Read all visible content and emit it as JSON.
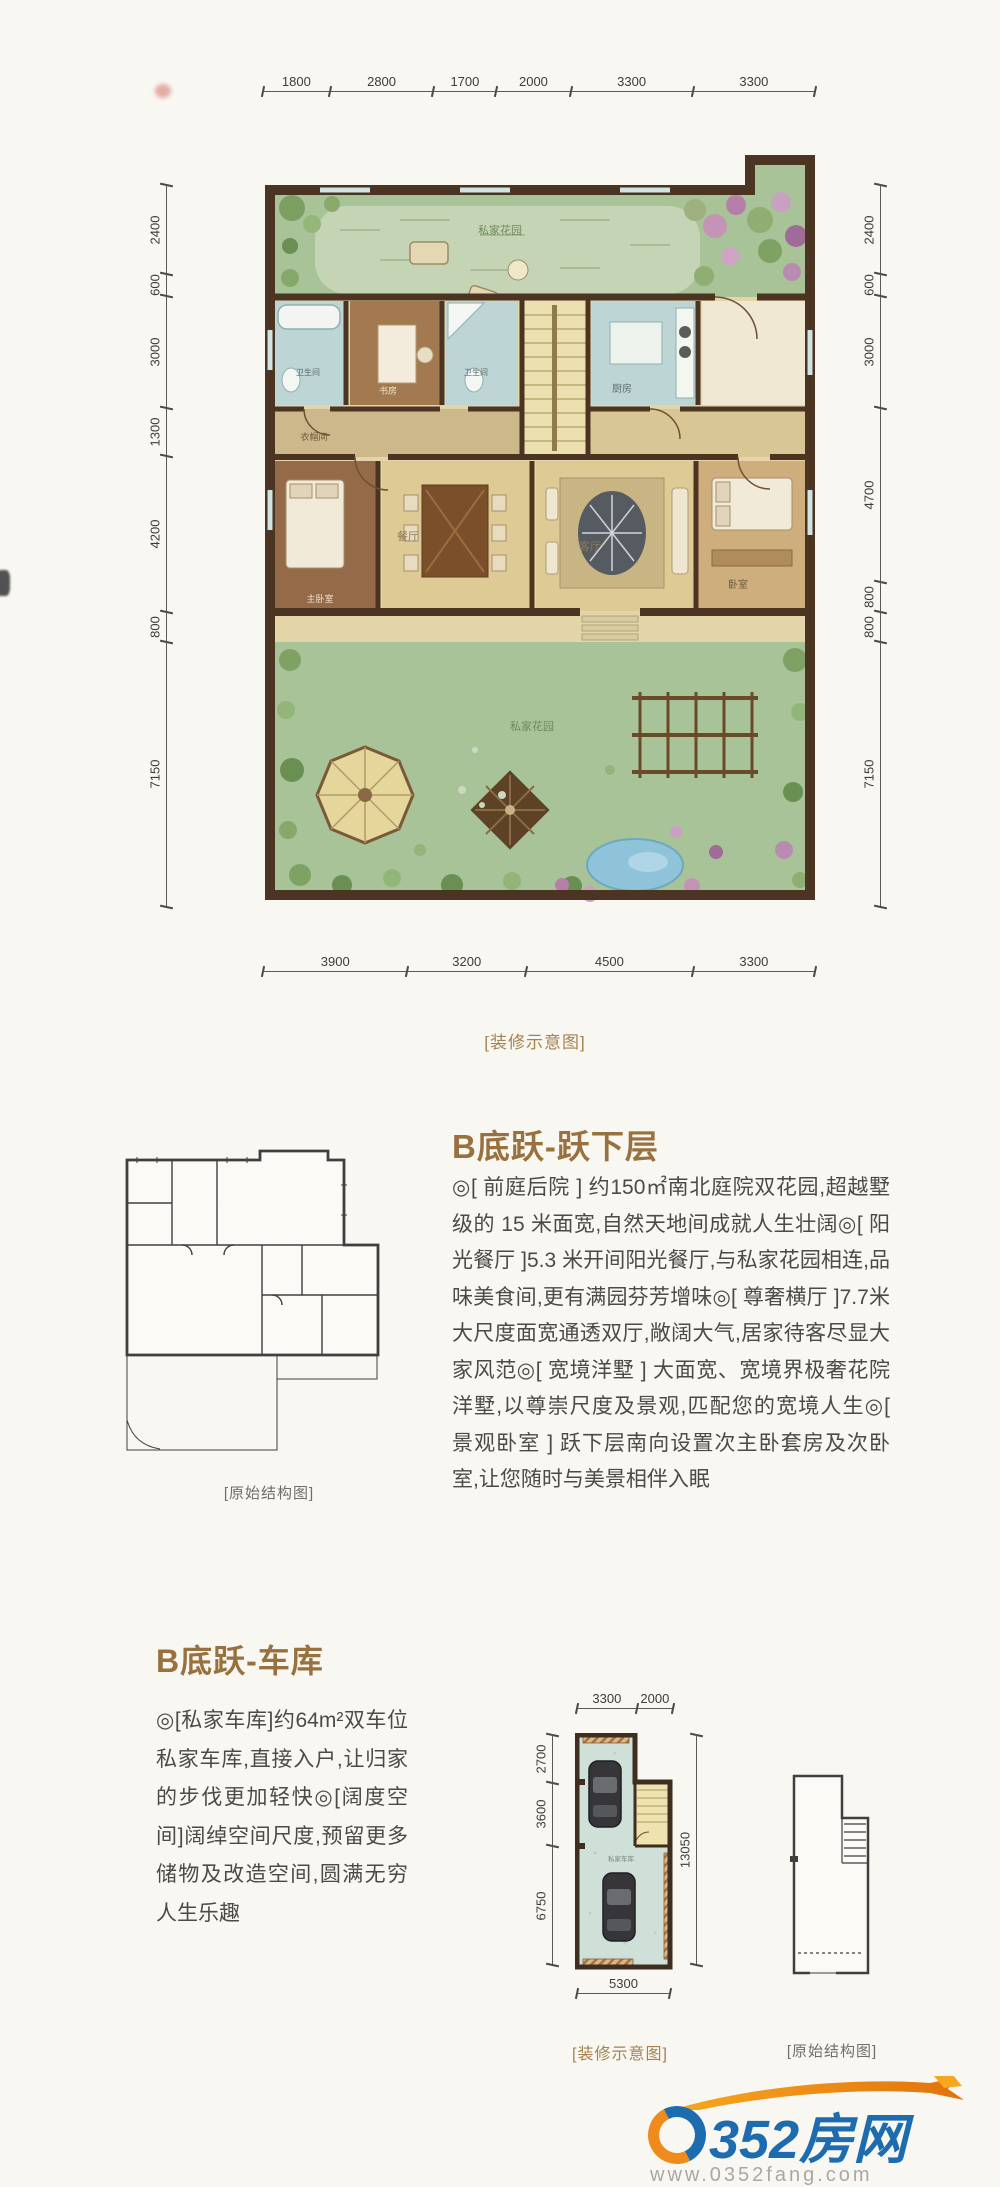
{
  "floorplan_top": {
    "dims_top": [
      "1800",
      "2800",
      "1700",
      "2000",
      "3300",
      "3300"
    ],
    "dims_left": [
      "2400",
      "600",
      "3000",
      "1300",
      "4200",
      "800",
      "7150"
    ],
    "dims_right": [
      "2400",
      "600",
      "3000",
      "4700",
      "800",
      "800",
      "7150"
    ],
    "dims_bottom": [
      "3900",
      "3200",
      "4500",
      "3300"
    ],
    "caption": "[装修示意图]",
    "rooms": {
      "garden_top": "私家花园",
      "garden_bottom": "私家花园",
      "bath1": "卫生间",
      "study": "书房",
      "bath2": "卫生间",
      "kitchen": "厨房",
      "cloak": "衣帽间",
      "master": "主卧室",
      "dining": "餐厅",
      "living": "客厅",
      "bedroom": "卧室"
    }
  },
  "section_lower": {
    "title": "B底跃-跃下层",
    "body": "◎[ 前庭后院 ] 约150㎡南北庭院双花园,超越墅级的 15 米面宽,自然天地间成就人生壮阔◎[ 阳光餐厅 ]5.3 米开间阳光餐厅,与私家花园相连,品味美食间,更有满园芬芳增味◎[ 尊奢横厅 ]7.7米大尺度面宽通透双厅,敞阔大气,居家待客尽显大家风范◎[ 宽境洋墅 ] 大面宽、宽境界极奢花院洋墅,以尊崇尺度及景观,匹配您的宽境人生◎[ 景观卧室 ] 跃下层南向设置次主卧套房及次卧室,让您随时与美景相伴入眠",
    "structural_caption": "[原始结构图]"
  },
  "section_garage": {
    "title": "B底跃-车库",
    "body": "◎[私家车库]约64m²双车位私家车库,直接入户,让归家的步伐更加轻快◎[阔度空间]阔绰空间尺度,预留更多储物及改造空间,圆满无穷人生乐趣",
    "plan": {
      "dims_top": [
        "3300",
        "2000"
      ],
      "dims_left": [
        "2700",
        "3600",
        "6750"
      ],
      "dims_right": [
        "13050"
      ],
      "dims_bottom": [
        "5300"
      ],
      "room": "私家车库",
      "caption": "[装修示意图]"
    },
    "structural_caption": "[原始结构图]"
  },
  "footer": {
    "logo_zero": "0",
    "logo_rest": "352房网",
    "url": "www.0352fang.com"
  },
  "colors": {
    "title_bronze": "#98713e",
    "caption_brown": "#a5824e",
    "wall_brown": "#4b3422",
    "garden_green": "#a9c399",
    "floor_tan": "#ddca95",
    "wet_blue": "#bdd6d5",
    "logo_blue": "#1d6cb0",
    "logo_orange": "#ef8b1c"
  }
}
